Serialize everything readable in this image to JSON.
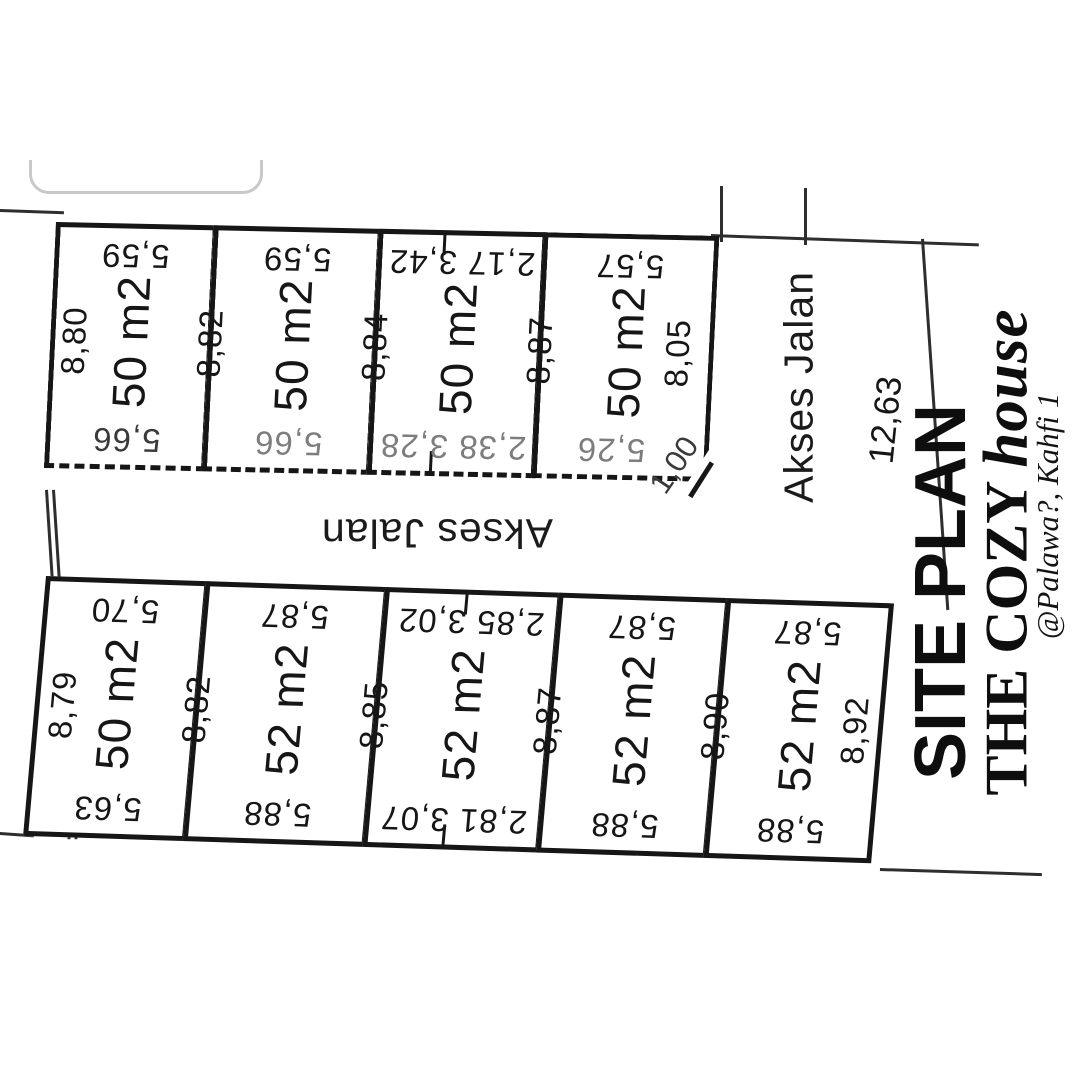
{
  "title_block": {
    "line1": "SITE PLAN",
    "line2_serif": "THE COZY ",
    "line2_script": "house",
    "line3": "@Palawa?, Kahfi 1"
  },
  "roads": {
    "between_rows": "Akses Jalan",
    "right_side": "Akses Jalan"
  },
  "outer_dims": {
    "right_boundary": "12,63",
    "corner_cut": "1,00"
  },
  "top_row": {
    "side_dims": [
      "8,80",
      "8,82",
      "8,84",
      "8,87",
      "8,05"
    ],
    "plots": [
      {
        "area": "50 m2",
        "top": "5,59",
        "bottom": "5,66"
      },
      {
        "area": "50 m2",
        "top": "5,59",
        "bottom": "5,66"
      },
      {
        "area": "50 m2",
        "top": "2,17 3,42",
        "bottom": "2,38 3,28"
      },
      {
        "area": "50 m2",
        "top": "5,57",
        "bottom": "5,26"
      }
    ]
  },
  "bottom_row": {
    "side_dims": [
      "8,79",
      "8,82",
      "8,85",
      "8,87",
      "8,90",
      "8,92"
    ],
    "plots": [
      {
        "area": "50 m2",
        "top": "5,70",
        "bottom": "5,63"
      },
      {
        "area": "52 m2",
        "top": "5,87",
        "bottom": "5,88"
      },
      {
        "area": "52 m2",
        "top": "2,85 3,02",
        "bottom": "2,81 3,07"
      },
      {
        "area": "52 m2",
        "top": "5,87",
        "bottom": "5,88"
      },
      {
        "area": "52 m2",
        "top": "5,87",
        "bottom": "5,88"
      }
    ]
  }
}
